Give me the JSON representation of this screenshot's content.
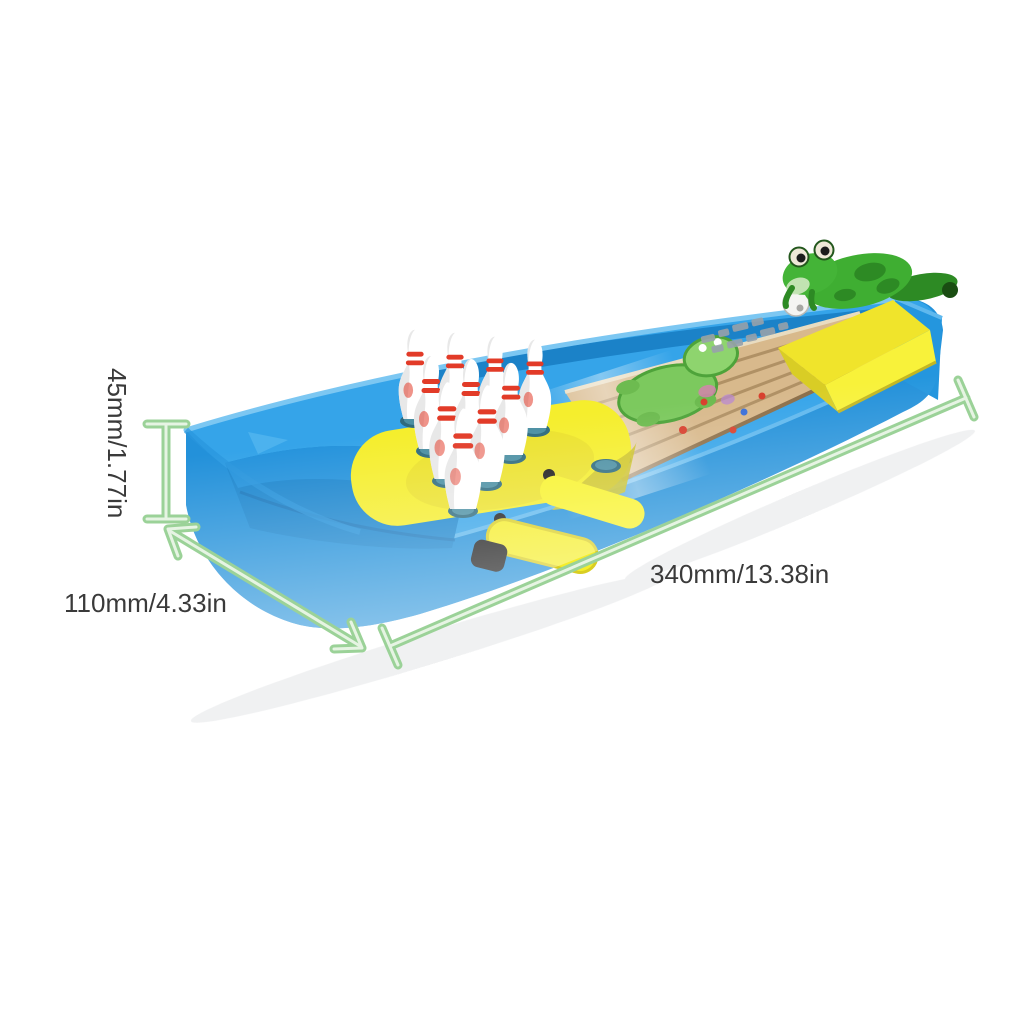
{
  "page": {
    "background": "#ffffff",
    "kind": "product-dimension-photo"
  },
  "annotations": {
    "height_label": "45mm/1.77in",
    "depth_label": "110mm/4.33in",
    "length_label": "340mm/13.38in",
    "dimension_line_color": "#9bd298",
    "label_text_color": "#3a3a3a"
  },
  "product": {
    "semantic": "mini-tabletop-frog-bowling-game",
    "components": [
      "blue-base-tray",
      "ball-return-tray",
      "yellow-pin-deck",
      "ten-bowling-pins",
      "wooden-bowling-lane",
      "frog-print-on-lane",
      "yellow-launch-ramp",
      "green-frog-launcher",
      "bowling-ball",
      "yellow-launch-lever",
      "black-lever-knob"
    ],
    "palette": {
      "base_blue": "#2d9fe6",
      "base_blue_dark": "#1d86cc",
      "accent_yellow": "#f5ee2d",
      "lane_wood": "#d8b98c",
      "lane_stripe": "#b3946a",
      "pin_white": "#ffffff",
      "pin_stripe_red": "#e23b28",
      "pin_hole_teal": "#35707f",
      "frog_green": "#3fae32"
    }
  }
}
